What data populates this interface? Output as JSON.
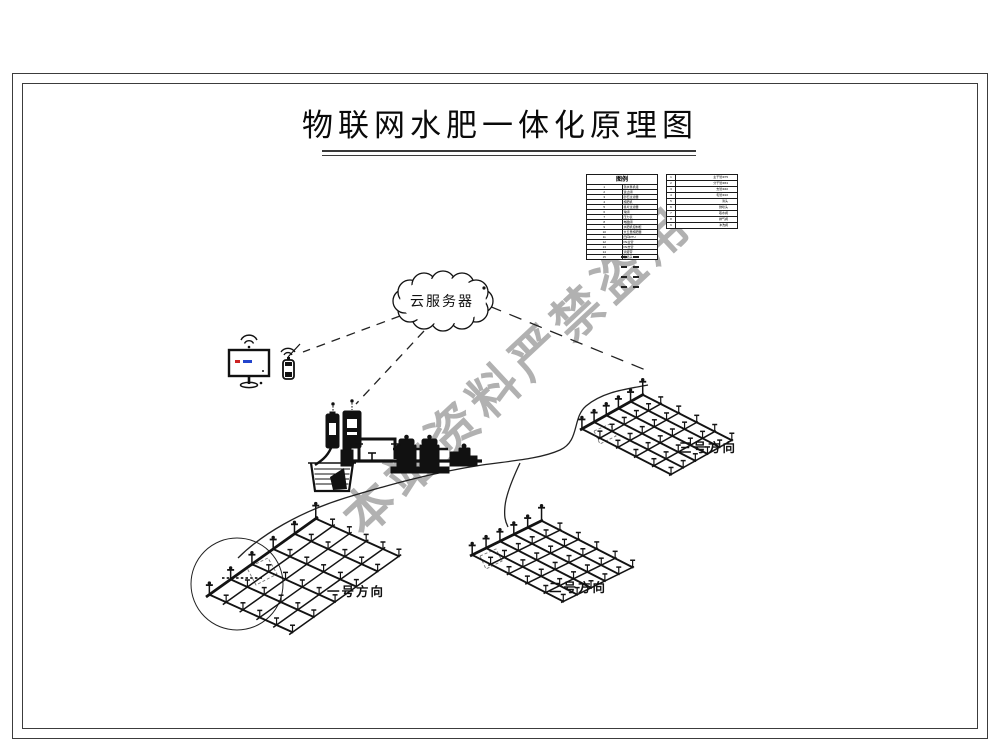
{
  "title": "物联网水肥一体化原理图",
  "watermark": {
    "text": "本站资料严禁盗用",
    "color": "#a9a9a9"
  },
  "cloud": {
    "label": "云服务器"
  },
  "fields": [
    {
      "label": "一号方向"
    },
    {
      "label": "二号方向"
    },
    {
      "label": "三号方向"
    }
  ],
  "legend1": {
    "header": "图例",
    "rows": [
      {
        "n": "1",
        "t": "潜水泵机组"
      },
      {
        "n": "2",
        "t": "逆止阀"
      },
      {
        "n": "3",
        "t": "砂石过滤器"
      },
      {
        "n": "4",
        "t": "施肥机"
      },
      {
        "n": "5",
        "t": "叠片过滤器"
      },
      {
        "n": "6",
        "t": "球阀"
      },
      {
        "n": "7",
        "t": "压力表"
      },
      {
        "n": "8",
        "t": "电磁阀"
      },
      {
        "n": "9",
        "t": "水肥机控制柜"
      },
      {
        "n": "10",
        "t": "文丘里施肥器"
      },
      {
        "n": "11",
        "t": "田间RTU"
      },
      {
        "n": "12",
        "t": "PE主管"
      },
      {
        "n": "13",
        "t": "PE支管"
      },
      {
        "n": "14",
        "t": "滴灌带"
      },
      {
        "n": "15",
        "t": "微喷头"
      }
    ]
  },
  "legend2": {
    "rows": [
      {
        "n": "1",
        "t": "主干管Φ75"
      },
      {
        "n": "2",
        "t": "分干管Φ63"
      },
      {
        "n": "3",
        "t": "支管Φ40"
      },
      {
        "n": "4",
        "t": "毛管Φ16"
      },
      {
        "n": "5",
        "t": "滴头"
      },
      {
        "n": "6",
        "t": "微喷头"
      },
      {
        "n": "7",
        "t": "取水阀"
      },
      {
        "n": "8",
        "t": "排气阀"
      },
      {
        "n": "9",
        "t": "冲洗阀"
      }
    ]
  },
  "icons": {
    "cloud": "cloud-server-icon",
    "monitor": "pc-monitor-icon",
    "phone": "mobile-phone-icon",
    "wifi": "wifi-signal-icon",
    "basin": "water-basin-icon",
    "pump": "pump-icon",
    "filter": "filter-tanks-icon",
    "fertilizer_tanks": "fertilizer-tank-icon"
  }
}
